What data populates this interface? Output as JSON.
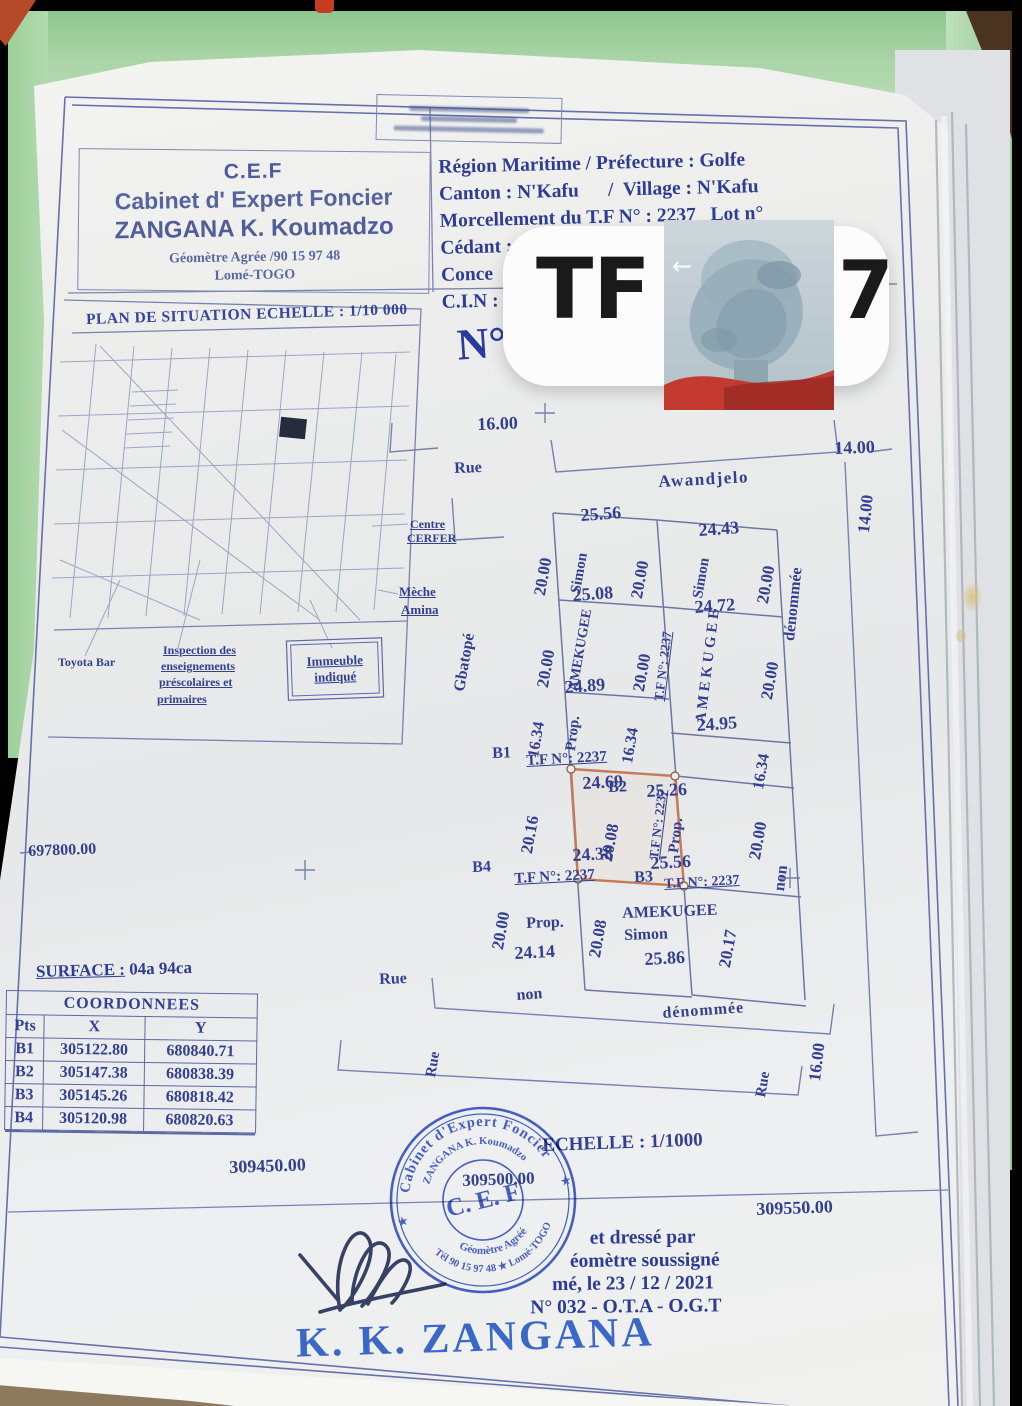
{
  "header": {
    "cef": {
      "acronym": "C.E.F",
      "line2": "Cabinet d' Expert Foncier",
      "line3": "ZANGANA K. Koumadzo",
      "line4": "Géomètre Agrée /90 15 97 48",
      "line5": "Lomé-TOGO"
    },
    "info_lines": [
      "Région Maritime / Préfecture : Golfe",
      "Canton : N'Kafu      /  Village : N'Kafu",
      "Morcellement du T.F N° : 2237   Lot n°",
      "Cédant : AMEKUGEE Simon",
      "Conce",
      "C.I.N :"
    ]
  },
  "overlay": {
    "tf_prefix": "TF",
    "tf_suffix": "7",
    "back_arrow": "←"
  },
  "plan_number_label": "N°",
  "situation_plan": {
    "title": "PLAN DE SITUATION ECHELLE : 1/10 000",
    "immeuble": {
      "line1": "Immeuble",
      "line2": "indiqué"
    },
    "labels": [
      {
        "t": "Centre",
        "x": 410,
        "y": 518,
        "s": 12,
        "u": 1
      },
      {
        "t": "CERFER",
        "x": 407,
        "y": 532,
        "s": 12,
        "u": 1
      },
      {
        "t": "Mèche",
        "x": 399,
        "y": 585,
        "s": 13,
        "u": 1
      },
      {
        "t": "Amina",
        "x": 401,
        "y": 603,
        "s": 13,
        "u": 1
      },
      {
        "t": "Toyota Bar",
        "x": 58,
        "y": 656,
        "s": 12
      },
      {
        "t": "Inspection des",
        "x": 163,
        "y": 644,
        "s": 12,
        "u": 1
      },
      {
        "t": "enseignements",
        "x": 161,
        "y": 660,
        "s": 12,
        "u": 1
      },
      {
        "t": "préscolaires et",
        "x": 159,
        "y": 676,
        "s": 12,
        "u": 1
      },
      {
        "t": "primaires",
        "x": 157,
        "y": 693,
        "s": 12,
        "u": 1
      }
    ]
  },
  "parcel_plan": {
    "labels": [
      {
        "t": "16.00",
        "x": 477,
        "y": 415,
        "r": -2,
        "s": 18
      },
      {
        "t": "Rue",
        "x": 454,
        "y": 461,
        "r": -2,
        "s": 16
      },
      {
        "t": "Awandjelo",
        "x": 658,
        "y": 473,
        "r": -3,
        "s": 17,
        "sp": 1.5
      },
      {
        "t": "14.00",
        "x": 834,
        "y": 439,
        "r": -2,
        "s": 18
      },
      {
        "t": "14.00",
        "x": 855,
        "y": 532,
        "r": -84,
        "s": 17
      },
      {
        "t": "dénommée",
        "x": 782,
        "y": 640,
        "r": -84,
        "s": 16
      },
      {
        "t": "Gbatopé",
        "x": 452,
        "y": 690,
        "r": -80,
        "s": 16
      },
      {
        "t": "25.56",
        "x": 580,
        "y": 506,
        "r": -4,
        "s": 18
      },
      {
        "t": "24.43",
        "x": 698,
        "y": 521,
        "r": -4,
        "s": 18
      },
      {
        "t": "20.00",
        "x": 531,
        "y": 594,
        "r": -80,
        "s": 17
      },
      {
        "t": "Simon",
        "x": 569,
        "y": 592,
        "r": -80,
        "s": 15
      },
      {
        "t": "20.00",
        "x": 628,
        "y": 597,
        "r": -80,
        "s": 17
      },
      {
        "t": "Simon",
        "x": 691,
        "y": 597,
        "r": -80,
        "s": 15
      },
      {
        "t": "20.00",
        "x": 754,
        "y": 602,
        "r": -80,
        "s": 17
      },
      {
        "t": "25.08",
        "x": 572,
        "y": 586,
        "r": -4,
        "s": 18
      },
      {
        "t": "24.72",
        "x": 694,
        "y": 598,
        "r": -4,
        "s": 18
      },
      {
        "t": "20.00",
        "x": 534,
        "y": 686,
        "r": -80,
        "s": 17
      },
      {
        "t": "AMEKUGEE",
        "x": 567,
        "y": 690,
        "r": -80,
        "s": 14
      },
      {
        "t": "20.00",
        "x": 630,
        "y": 690,
        "r": -80,
        "s": 17
      },
      {
        "t": "T.F N°: 2237",
        "x": 652,
        "y": 700,
        "r": -83,
        "s": 13,
        "u": 1
      },
      {
        "t": "A M E K U G E E",
        "x": 694,
        "y": 722,
        "r": -83,
        "s": 15
      },
      {
        "t": "20.00",
        "x": 758,
        "y": 698,
        "r": -80,
        "s": 17
      },
      {
        "t": "24.89",
        "x": 564,
        "y": 678,
        "r": -4,
        "s": 18
      },
      {
        "t": "24.95",
        "x": 696,
        "y": 716,
        "r": -4,
        "s": 18
      },
      {
        "t": "16.34",
        "x": 526,
        "y": 756,
        "r": -80,
        "s": 16
      },
      {
        "t": "Prop.",
        "x": 564,
        "y": 750,
        "r": -83,
        "s": 15
      },
      {
        "t": "16.34",
        "x": 620,
        "y": 762,
        "r": -80,
        "s": 16
      },
      {
        "t": "16.34",
        "x": 751,
        "y": 788,
        "r": -80,
        "s": 16
      },
      {
        "t": "B1",
        "x": 492,
        "y": 746,
        "r": -2,
        "s": 16
      },
      {
        "t": "T.F N°: 2237",
        "x": 526,
        "y": 754,
        "r": -3,
        "s": 15,
        "u": 1
      },
      {
        "t": "B2",
        "x": 608,
        "y": 780,
        "r": -2,
        "s": 16
      },
      {
        "t": "25.26",
        "x": 646,
        "y": 782,
        "r": -3,
        "s": 18
      },
      {
        "t": "24.69",
        "x": 582,
        "y": 774,
        "r": -3,
        "s": 18
      },
      {
        "t": "20.16",
        "x": 518,
        "y": 852,
        "r": -80,
        "s": 17
      },
      {
        "t": "20.08",
        "x": 598,
        "y": 860,
        "r": -80,
        "s": 17
      },
      {
        "t": "24.38",
        "x": 572,
        "y": 846,
        "r": -3,
        "s": 18
      },
      {
        "t": "B4",
        "x": 472,
        "y": 860,
        "r": -2,
        "s": 16
      },
      {
        "t": "T.F N°: 2237",
        "x": 514,
        "y": 872,
        "r": -3,
        "s": 15,
        "u": 1
      },
      {
        "t": "T.F N°: 2237",
        "x": 647,
        "y": 858,
        "r": -83,
        "s": 13,
        "u": 1
      },
      {
        "t": "Prop.",
        "x": 667,
        "y": 852,
        "r": -83,
        "s": 15
      },
      {
        "t": "20.00",
        "x": 746,
        "y": 858,
        "r": -80,
        "s": 17
      },
      {
        "t": "25.56",
        "x": 650,
        "y": 854,
        "r": -3,
        "s": 18
      },
      {
        "t": "B3",
        "x": 634,
        "y": 870,
        "r": -2,
        "s": 16
      },
      {
        "t": "T.F N°: 2237",
        "x": 664,
        "y": 878,
        "r": -3,
        "s": 14,
        "u": 1
      },
      {
        "t": "20.00",
        "x": 489,
        "y": 948,
        "r": -80,
        "s": 17
      },
      {
        "t": "Prop.",
        "x": 526,
        "y": 916,
        "r": -2,
        "s": 16
      },
      {
        "t": "20.08",
        "x": 586,
        "y": 956,
        "r": -80,
        "s": 17
      },
      {
        "t": "24.14",
        "x": 514,
        "y": 944,
        "r": -3,
        "s": 18
      },
      {
        "t": "AMEKUGEE",
        "x": 622,
        "y": 906,
        "r": -2,
        "s": 16
      },
      {
        "t": "Simon",
        "x": 624,
        "y": 928,
        "r": -2,
        "s": 16
      },
      {
        "t": "20.17",
        "x": 716,
        "y": 966,
        "r": -80,
        "s": 17
      },
      {
        "t": "25.86",
        "x": 644,
        "y": 950,
        "r": -3,
        "s": 18
      },
      {
        "t": "non",
        "x": 772,
        "y": 890,
        "r": -83,
        "s": 16
      },
      {
        "t": "Rue",
        "x": 379,
        "y": 972,
        "r": -2,
        "s": 16
      },
      {
        "t": "non",
        "x": 516,
        "y": 988,
        "r": -4,
        "s": 16
      },
      {
        "t": "dénommée",
        "x": 662,
        "y": 1006,
        "r": -4,
        "s": 16,
        "sp": 1
      },
      {
        "t": "Rue",
        "x": 424,
        "y": 1076,
        "r": -80,
        "s": 15
      },
      {
        "t": "Rue",
        "x": 754,
        "y": 1096,
        "r": -80,
        "s": 15
      },
      {
        "t": "16.00",
        "x": 806,
        "y": 1080,
        "r": -83,
        "s": 17
      },
      {
        "t": "697800.00",
        "x": 28,
        "y": 844,
        "r": -2,
        "s": 16
      },
      {
        "t": "309450.00",
        "x": 229,
        "y": 1158,
        "r": -2,
        "s": 18
      },
      {
        "t": "309500.00",
        "x": 462,
        "y": 1172,
        "r": -2,
        "s": 17
      },
      {
        "t": "309550.00",
        "x": 756,
        "y": 1200,
        "r": -2,
        "s": 18
      },
      {
        "t": "ECHELLE : 1/1000",
        "x": 542,
        "y": 1136,
        "r": -2,
        "s": 19
      }
    ]
  },
  "surface": {
    "label": "SURFACE :",
    "value": " 04a 94ca"
  },
  "coordinates_table": {
    "title": "COORDONNEES",
    "columns": [
      "Pts",
      "X",
      "Y"
    ],
    "rows": [
      [
        "B1",
        "305122.80",
        "680840.71"
      ],
      [
        "B2",
        "305147.38",
        "680838.39"
      ],
      [
        "B3",
        "305145.26",
        "680818.42"
      ],
      [
        "B4",
        "305120.98",
        "680820.63"
      ]
    ]
  },
  "stamp": {
    "ring_top": "Cabinet d'Expert Foncier",
    "ring_name": "ZANGANA K. Koumadzo",
    "center": "C. E. F",
    "ring_bottom_inner": "Géomètre Agréé",
    "ring_bottom_outer": "Tél 90 15 97 48 ★ Lomé-TOGO",
    "star_left": "★",
    "star_right": "★"
  },
  "attestation": {
    "lines": [
      "et dressé par",
      "éomètre  soussigné",
      "mé, le  23 / 12 / 2021",
      "N° 032 - O.T.A - O.G.T"
    ]
  },
  "signature_name": "K. K. ZANGANA"
}
